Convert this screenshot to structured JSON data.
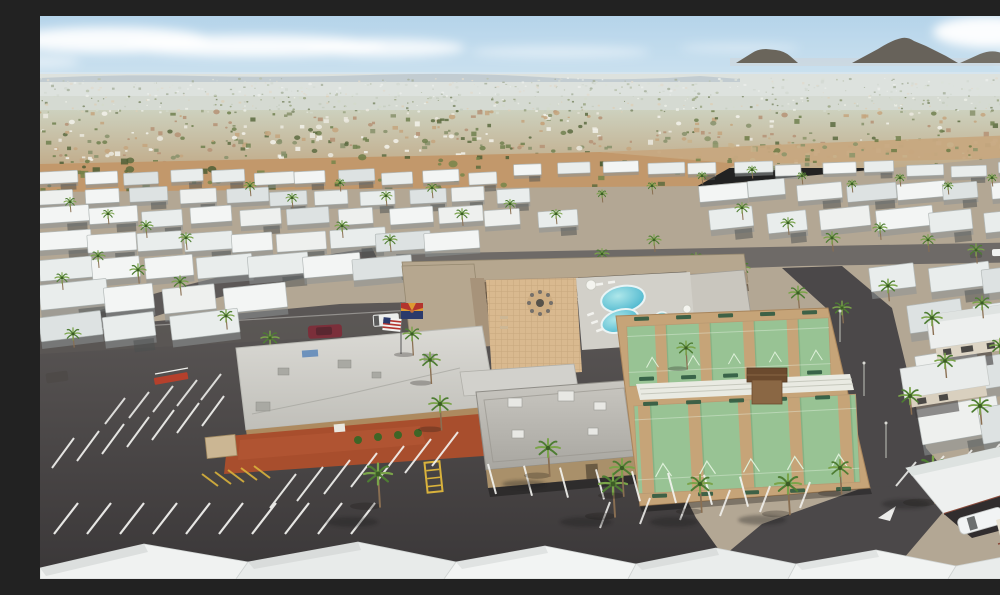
{
  "meta": {
    "title": "Aerial drone view of a desert 55+ mobile-home park resort with clubhouse, swimming pool, spa, shuffleboard courts, parking lot, palm trees, rows of white-roofed homes, distant city sprawl and mountains under a hazy blue sky",
    "type": "aerial-photograph",
    "features": [
      "sky",
      "clouds",
      "mountains",
      "distant-city",
      "desert-strip",
      "mobile-home-rows",
      "clubhouse",
      "courtyard",
      "fire-pit",
      "swimming-pool",
      "spa",
      "shuffleboard-courts",
      "equipment-shed",
      "parking-lot",
      "parking-stripes",
      "roads",
      "american-flag",
      "arizona-flag",
      "palm-trees",
      "vehicles",
      "foreground-roofs"
    ]
  },
  "palette": {
    "sky1": "#b5d4ea",
    "sky2": "#d9e9f2",
    "cloud": "#ffffff",
    "mtn": "#6a655b",
    "ridge": "#7189a1",
    "cityfar": "#d5dad2",
    "citymid1": "#cdd1be",
    "citymid2": "#c1ab89",
    "desert": "#c2986b",
    "dirt": "#c7a87f",
    "ground": "#b3a794",
    "asphalt": "#434041",
    "street": "#6e6a67",
    "roadside": "#4b4849",
    "tan": "#b6a78f",
    "awn": "#a7937a",
    "walltan": "#ad8a5f",
    "brick": "#a84e2d",
    "brick2": "#8a5036",
    "pav": "#d9b98f",
    "deck": "#d2d0c9",
    "pool1": "#2fa8c6",
    "pool2": "#aee7ea",
    "green": "#98c394",
    "lane": "#c6a478",
    "bench": "#2f5a40",
    "shed": "#8a6744",
    "shedroof": "#6b4a2e",
    "palm1": "#4e7d33",
    "palm2": "#7aa449",
    "trunk": "#8a6f52",
    "flagred": "#b3342e",
    "flagyel": "#dd9a33",
    "flagblue": "#2b3a6b",
    "copper": "#c06a36",
    "maroon": "#7b2f3a",
    "stripe": "#f5f5f2",
    "hatch": "#d9b23c"
  },
  "decor": {
    "scatter": [
      {
        "layer": "sc-distant",
        "x": 0,
        "y": 62,
        "w": 1000,
        "h": 34,
        "count": 650,
        "min": 1,
        "max": 3,
        "seed": 7,
        "colors": [
          "#eceee7",
          "#d3d9cb",
          "#9aa483",
          "#7e8a68",
          "#dccfb8",
          "#c5ccc0"
        ]
      },
      {
        "layer": "sc-mid",
        "x": 0,
        "y": 94,
        "w": 1000,
        "h": 56,
        "count": 500,
        "min": 2,
        "max": 5.5,
        "seed": 11,
        "colors": [
          "#ebe9df",
          "#f3f2eb",
          "#70804f",
          "#5c6b41",
          "#c4a57e",
          "#b59275",
          "#87916b"
        ]
      },
      {
        "layer": "sc-desert",
        "x": 0,
        "y": 138,
        "w": 660,
        "h": 40,
        "count": 64,
        "min": 3,
        "max": 8,
        "seed": 23,
        "colors": [
          "#5d6b3d",
          "#6d7b46",
          "#4f5e35",
          "#77854a"
        ]
      },
      {
        "layer": "sc-desert",
        "x": 640,
        "y": 120,
        "w": 360,
        "h": 26,
        "count": 55,
        "min": 2,
        "max": 6,
        "seed": 31,
        "colors": [
          "#6d7b46",
          "#8b9468",
          "#c8b18b"
        ]
      }
    ],
    "home_shades": [
      "#f3f5f4",
      "#e9edec",
      "#dde2e2",
      "#eef0ee"
    ],
    "home_rows": [
      {
        "x0": 0,
        "x1": 470,
        "y": 156,
        "n": 11,
        "w": 34,
        "h": 12,
        "rot": -3,
        "seed": 3
      },
      {
        "x0": 0,
        "x1": 505,
        "y": 174,
        "n": 11,
        "w": 38,
        "h": 14,
        "rot": -3,
        "seed": 5
      },
      {
        "x0": 0,
        "x1": 545,
        "y": 194,
        "n": 11,
        "w": 42,
        "h": 16,
        "rot": -4,
        "seed": 9
      },
      {
        "x0": 0,
        "x1": 430,
        "y": 217,
        "n": 9,
        "w": 48,
        "h": 18,
        "rot": -4,
        "seed": 13
      },
      {
        "x0": 0,
        "x1": 365,
        "y": 243,
        "n": 7,
        "w": 54,
        "h": 21,
        "rot": -5,
        "seed": 17
      },
      {
        "x0": 0,
        "x1": 245,
        "y": 272,
        "n": 4,
        "w": 60,
        "h": 25,
        "rot": -6,
        "seed": 19
      },
      {
        "x0": 0,
        "x1": 190,
        "y": 300,
        "n": 3,
        "w": 58,
        "h": 24,
        "rot": -7,
        "seed": 29
      },
      {
        "x0": 475,
        "x1": 1000,
        "y": 148,
        "n": 12,
        "w": 32,
        "h": 11,
        "rot": -2,
        "seed": 37
      },
      {
        "x0": 660,
        "x1": 1000,
        "y": 168,
        "n": 7,
        "w": 42,
        "h": 16,
        "rot": -5,
        "seed": 41
      },
      {
        "x0": 670,
        "x1": 1000,
        "y": 196,
        "n": 6,
        "w": 48,
        "h": 20,
        "rot": -6,
        "seed": 43
      },
      {
        "x0": 830,
        "x1": 1000,
        "y": 252,
        "n": 3,
        "w": 56,
        "h": 24,
        "rot": -7,
        "seed": 47
      },
      {
        "x0": 868,
        "x1": 1000,
        "y": 292,
        "n": 2,
        "w": 64,
        "h": 28,
        "rot": -8,
        "seed": 53
      },
      {
        "x0": 876,
        "x1": 1000,
        "y": 340,
        "n": 2,
        "w": 70,
        "h": 32,
        "rot": -9,
        "seed": 59
      },
      {
        "x0": 878,
        "x1": 1000,
        "y": 392,
        "n": 2,
        "w": 78,
        "h": 36,
        "rot": -10,
        "seed": 61
      }
    ],
    "palms": {
      "mid": [
        [
          30,
          186,
          6
        ],
        [
          68,
          198,
          6
        ],
        [
          106,
          210,
          7
        ],
        [
          146,
          222,
          7
        ],
        [
          58,
          240,
          7
        ],
        [
          98,
          254,
          8
        ],
        [
          22,
          262,
          7
        ],
        [
          140,
          266,
          8
        ],
        [
          186,
          300,
          8
        ],
        [
          230,
          322,
          9
        ],
        [
          33,
          318,
          8
        ],
        [
          210,
          170,
          6
        ],
        [
          252,
          182,
          6
        ],
        [
          300,
          167,
          5
        ],
        [
          346,
          180,
          6
        ],
        [
          392,
          172,
          6
        ],
        [
          302,
          210,
          7
        ],
        [
          350,
          224,
          7
        ],
        [
          422,
          198,
          7
        ],
        [
          470,
          188,
          6
        ],
        [
          516,
          198,
          6
        ],
        [
          562,
          178,
          5
        ],
        [
          612,
          170,
          5
        ],
        [
          662,
          160,
          5
        ],
        [
          712,
          154,
          5
        ],
        [
          762,
          160,
          5
        ],
        [
          812,
          168,
          5
        ],
        [
          860,
          162,
          5
        ],
        [
          908,
          170,
          5
        ],
        [
          952,
          162,
          5
        ],
        [
          990,
          170,
          5
        ],
        [
          702,
          192,
          7
        ],
        [
          748,
          207,
          7
        ],
        [
          792,
          222,
          8
        ],
        [
          840,
          212,
          7
        ],
        [
          888,
          224,
          7
        ],
        [
          936,
          234,
          8
        ],
        [
          976,
          246,
          8
        ],
        [
          758,
          277,
          9
        ],
        [
          802,
          292,
          9
        ],
        [
          848,
          270,
          9
        ],
        [
          892,
          302,
          10
        ],
        [
          942,
          287,
          9
        ],
        [
          702,
          252,
          8
        ],
        [
          656,
          242,
          7
        ],
        [
          614,
          224,
          7
        ],
        [
          562,
          238,
          7
        ],
        [
          905,
          345,
          10
        ],
        [
          960,
          330,
          10
        ],
        [
          870,
          380,
          11
        ],
        [
          940,
          390,
          11
        ],
        [
          995,
          420,
          11
        ]
      ],
      "front": [
        [
          372,
          318,
          9
        ],
        [
          338,
          458,
          14
        ],
        [
          390,
          344,
          10
        ],
        [
          400,
          388,
          11
        ],
        [
          508,
          432,
          12
        ],
        [
          573,
          468,
          14
        ],
        [
          660,
          468,
          12
        ],
        [
          748,
          468,
          13
        ],
        [
          800,
          452,
          11
        ],
        [
          893,
          452,
          15
        ],
        [
          965,
          452,
          12
        ],
        [
          582,
          452,
          12
        ],
        [
          646,
          332,
          9
        ]
      ]
    },
    "stripe_sets": [
      {
        "x": 12,
        "y": 452,
        "sx": 25,
        "sy": -7,
        "n": 7,
        "dx": 22,
        "dy": -30,
        "w": 2,
        "color": "#f5f5f2",
        "o": 0.9
      },
      {
        "x": 65,
        "y": 408,
        "sx": 24,
        "sy": -6,
        "n": 5,
        "dx": 20,
        "dy": -26,
        "w": 2,
        "color": "#f5f5f2",
        "o": 0.85
      },
      {
        "x": 230,
        "y": 492,
        "sx": 27,
        "sy": -7,
        "n": 7,
        "dx": 26,
        "dy": -34,
        "w": 2,
        "color": "#f5f5f2",
        "o": 0.9
      },
      {
        "x": 448,
        "y": 448,
        "sx": 36,
        "sy": 1.8,
        "n": 8,
        "dx": 8,
        "dy": 30,
        "w": 2,
        "color": "#f5f5f2",
        "o": 0.9
      },
      {
        "x": 14,
        "y": 518,
        "sx": 33,
        "sy": 0,
        "n": 10,
        "dx": 24,
        "dy": -31,
        "w": 2.2,
        "color": "#f5f5f2",
        "o": 0.92
      },
      {
        "x": 560,
        "y": 512,
        "sx": 40,
        "sy": -4,
        "n": 6,
        "dx": 10,
        "dy": -26,
        "w": 2,
        "color": "#f5f5f2",
        "o": 0.85
      },
      {
        "x": 856,
        "y": 470,
        "sx": 28,
        "sy": -6,
        "n": 4,
        "dx": 20,
        "dy": -24,
        "w": 2,
        "color": "#f5f5f2",
        "o": 0.85
      },
      {
        "x": 944,
        "y": 512,
        "sx": 30,
        "sy": -6,
        "n": 2,
        "dx": 20,
        "dy": -26,
        "w": 2,
        "color": "#f5f5f2",
        "o": 0.85
      },
      {
        "x": 162,
        "y": 458,
        "sx": 13,
        "sy": -2,
        "n": 5,
        "dx": 16,
        "dy": 12,
        "w": 2,
        "color": "#d9b23c",
        "o": 0.9
      }
    ],
    "bench_rows": [
      {
        "x0": 594,
        "y0": 301,
        "n": 5,
        "dx": 42,
        "dy": -1.6
      },
      {
        "x0": 599,
        "y0": 361,
        "n": 5,
        "dx": 42,
        "dy": -1.6
      },
      {
        "x0": 603,
        "y0": 386,
        "n": 5,
        "dx": 43,
        "dy": -1.6
      },
      {
        "x0": 612,
        "y0": 478,
        "n": 5,
        "dx": 46,
        "dy": -1.7
      }
    ]
  }
}
